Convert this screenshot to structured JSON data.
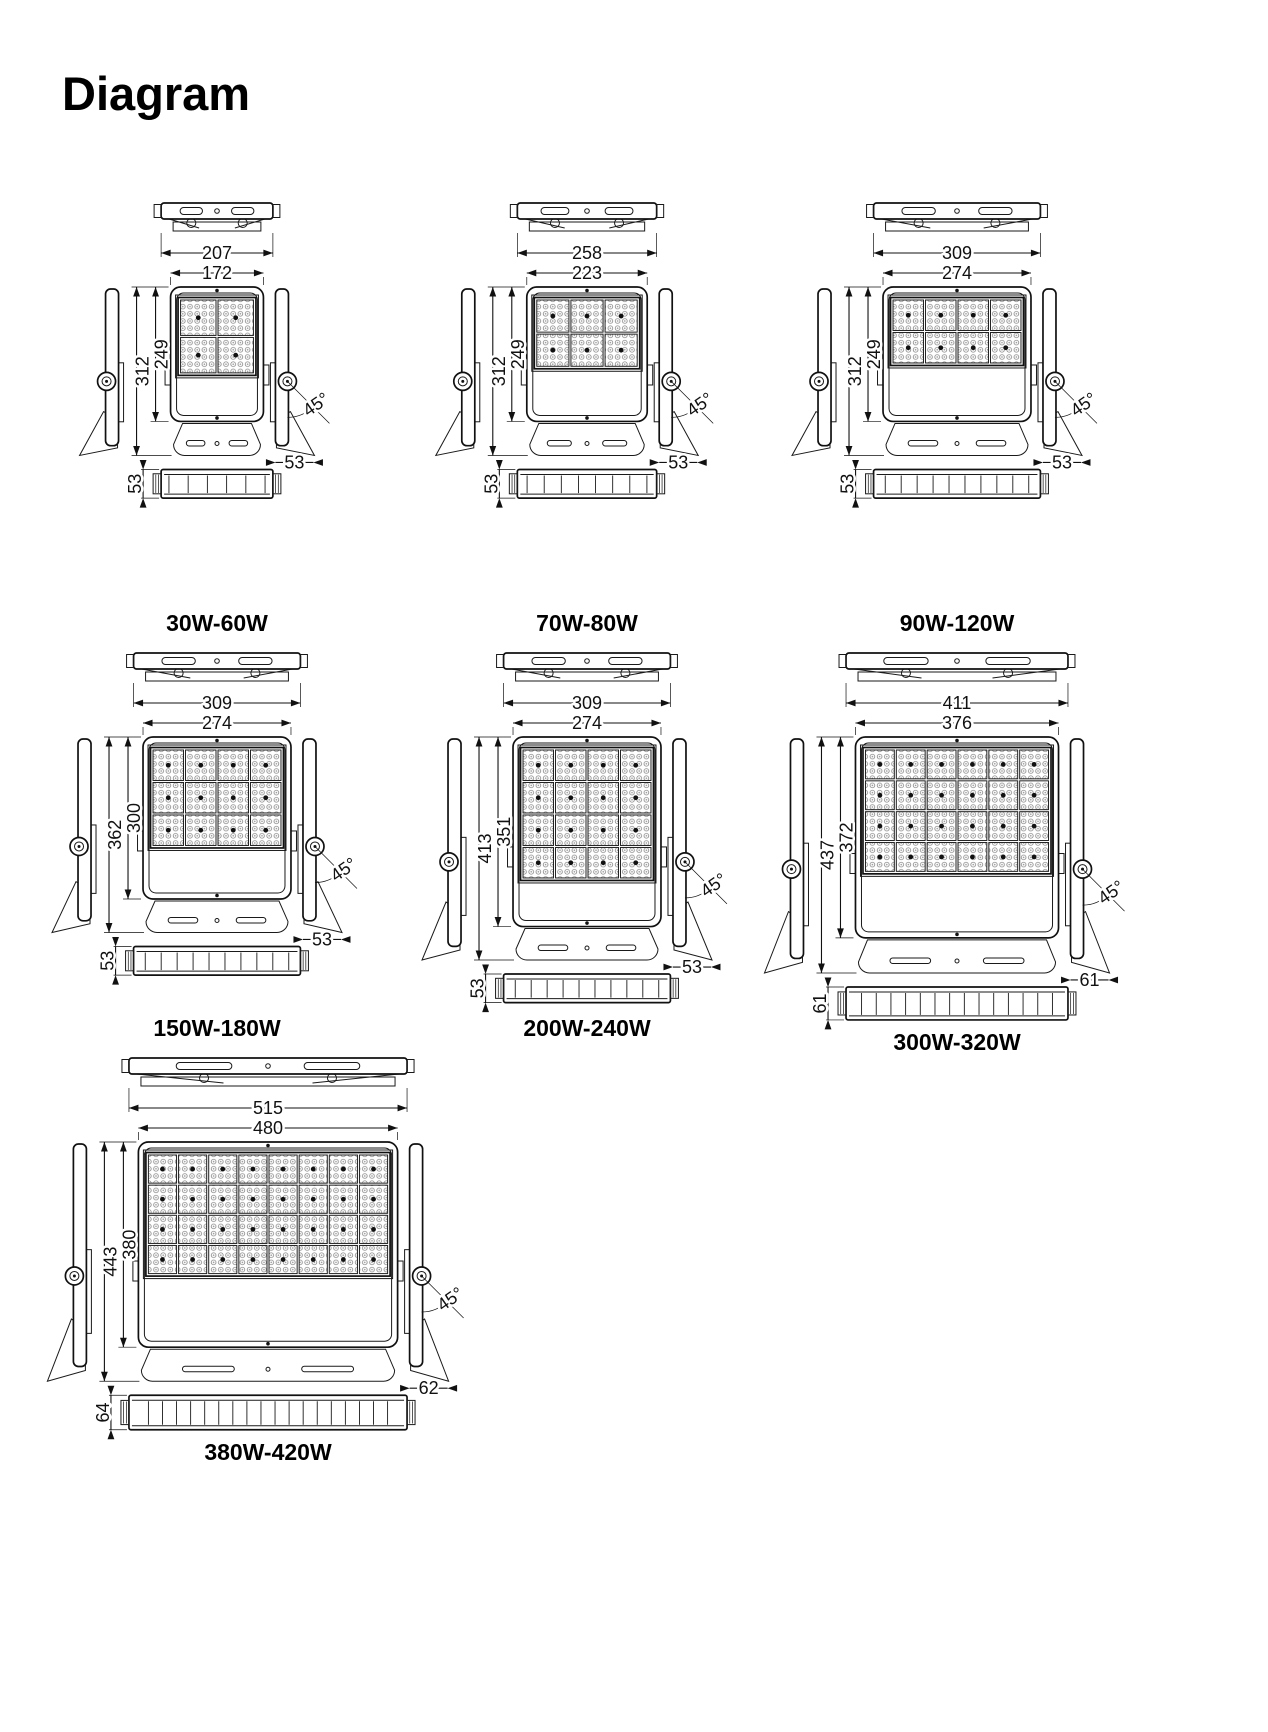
{
  "page": {
    "title": "Diagram",
    "background": "#ffffff",
    "line_color": "#1a1a1a",
    "text_color": "#111111"
  },
  "diagrams": [
    {
      "label": "30W-60W",
      "tilt_angle": "45°",
      "led_grid": {
        "cols": 2,
        "rows": 2
      },
      "dims": {
        "outer_width": 207,
        "inner_width": 172,
        "outer_height": 312,
        "inner_height": 249,
        "side_depth": 53,
        "bottom_height": 53
      }
    },
    {
      "label": "70W-80W",
      "tilt_angle": "45°",
      "led_grid": {
        "cols": 3,
        "rows": 2
      },
      "dims": {
        "outer_width": 258,
        "inner_width": 223,
        "outer_height": 312,
        "inner_height": 249,
        "side_depth": 53,
        "bottom_height": 53
      }
    },
    {
      "label": "90W-120W",
      "tilt_angle": "45°",
      "led_grid": {
        "cols": 4,
        "rows": 2
      },
      "dims": {
        "outer_width": 309,
        "inner_width": 274,
        "outer_height": 312,
        "inner_height": 249,
        "side_depth": 53,
        "bottom_height": 53
      }
    },
    {
      "label": "150W-180W",
      "tilt_angle": "45°",
      "led_grid": {
        "cols": 4,
        "rows": 3
      },
      "dims": {
        "outer_width": 309,
        "inner_width": 274,
        "outer_height": 362,
        "inner_height": 300,
        "side_depth": 53,
        "bottom_height": 53
      }
    },
    {
      "label": "200W-240W",
      "tilt_angle": "45°",
      "led_grid": {
        "cols": 4,
        "rows": 4
      },
      "dims": {
        "outer_width": 309,
        "inner_width": 274,
        "outer_height": 413,
        "inner_height": 351,
        "side_depth": 53,
        "bottom_height": 53
      }
    },
    {
      "label": "300W-320W",
      "tilt_angle": "45°",
      "led_grid": {
        "cols": 6,
        "rows": 4
      },
      "dims": {
        "outer_width": 411,
        "inner_width": 376,
        "outer_height": 437,
        "inner_height": 372,
        "side_depth": 61,
        "bottom_height": 61
      }
    },
    {
      "label": "380W-420W",
      "tilt_angle": "45°",
      "led_grid": {
        "cols": 8,
        "rows": 4
      },
      "dims": {
        "outer_width": 515,
        "inner_width": 480,
        "outer_height": 443,
        "inner_height": 380,
        "side_depth": 62,
        "bottom_height": 64
      }
    }
  ]
}
